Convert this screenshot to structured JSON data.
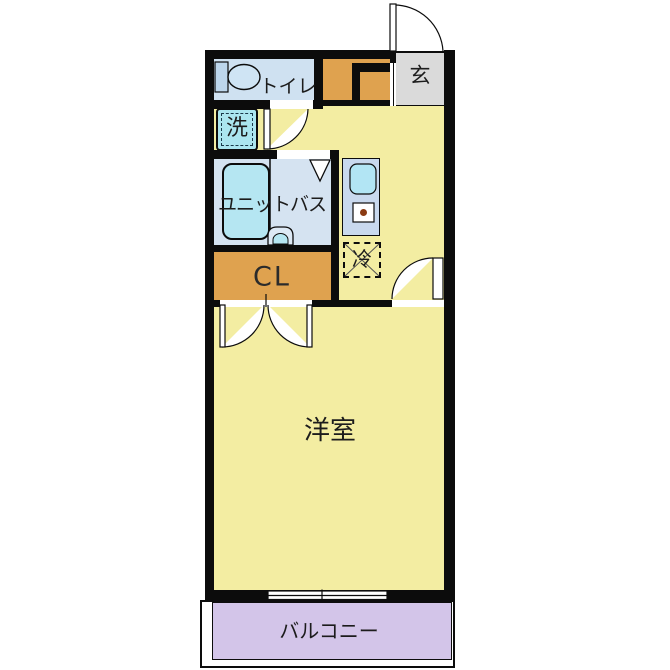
{
  "type": "floor-plan",
  "rooms": {
    "entrance": {
      "label": "玄"
    },
    "toilet": {
      "label": "トイレ"
    },
    "laundry": {
      "label": "洗"
    },
    "unit_bath": {
      "label": "ユニットバス"
    },
    "refrigerator": {
      "label": "冷"
    },
    "closet": {
      "label": "CL"
    },
    "western_room": {
      "label": "洋室"
    },
    "balcony": {
      "label": "バルコニー"
    }
  },
  "colors": {
    "wall_black": "#0c0c0c",
    "floor_yellow": "#f3eda2",
    "toilet_blue": "#cfe1f1",
    "unit_bath_blue": "#d5e3f1",
    "fixture_cyan": "#b5e6f2",
    "laundry_cyan": "#abe6ef",
    "storage_orange": "#dfa24f",
    "entrance_gray": "#dadada",
    "counter_blue": "#c9d9ee",
    "balcony_purple": "#d3c5e9",
    "burner_brown": "#8a3a12"
  }
}
